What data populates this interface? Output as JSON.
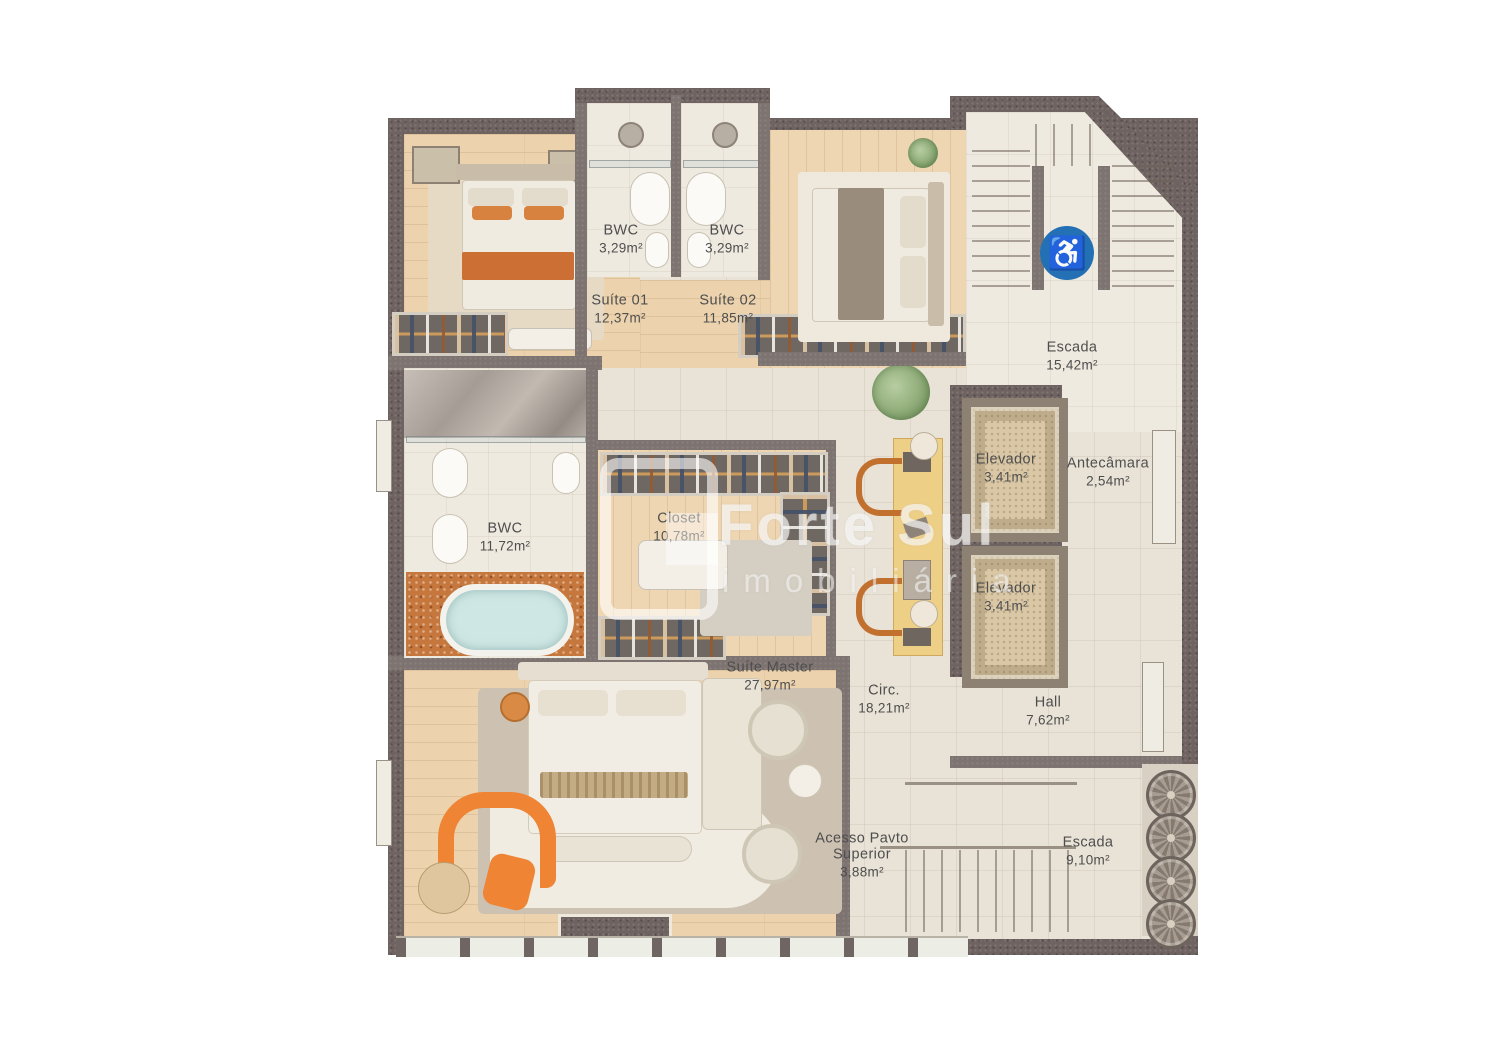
{
  "watermark": {
    "brand": "Forte Sul",
    "tagline": "imobiliária"
  },
  "rooms": {
    "suite01": {
      "label": "Suíte 01",
      "area": "12,37m²"
    },
    "bwc01": {
      "label": "BWC",
      "area": "3,29m²"
    },
    "bwc02": {
      "label": "BWC",
      "area": "3,29m²"
    },
    "suite02": {
      "label": "Suíte 02",
      "area": "11,85m²"
    },
    "escadaSup": {
      "label": "Escada",
      "area": "15,42m²"
    },
    "elev1": {
      "label": "Elevador",
      "area": "3,41m²"
    },
    "elev2": {
      "label": "Elevador",
      "area": "3,41m²"
    },
    "antecamara": {
      "label": "Antecâmara",
      "area": "2,54m²"
    },
    "bwcMaster": {
      "label": "BWC",
      "area": "11,72m²"
    },
    "closet": {
      "label": "Closet",
      "area": "10,78m²"
    },
    "suiteMaster": {
      "label": "Suíte Master",
      "area": "27,97m²"
    },
    "circ": {
      "label": "Circ.",
      "area": "18,21m²"
    },
    "hall": {
      "label": "Hall",
      "area": "7,62m²"
    },
    "acesso": {
      "line1": "Acesso Pavto",
      "line2": "Superior",
      "area": "3,88m²"
    },
    "escadaInf": {
      "label": "Escada",
      "area": "9,10m²"
    }
  },
  "icons": {
    "accessibility": "♿"
  },
  "colors": {
    "wall": "#6e6361",
    "wood_floor": "#ecd3ae",
    "tile_floor": "#e9e3d7",
    "mosaic_orange": "#c5773e",
    "tub_water": "#cfe7e4",
    "desk_yellow": "#eecf86",
    "chair_orange": "#ee8434",
    "accessibility_blue": "#2470b5"
  }
}
